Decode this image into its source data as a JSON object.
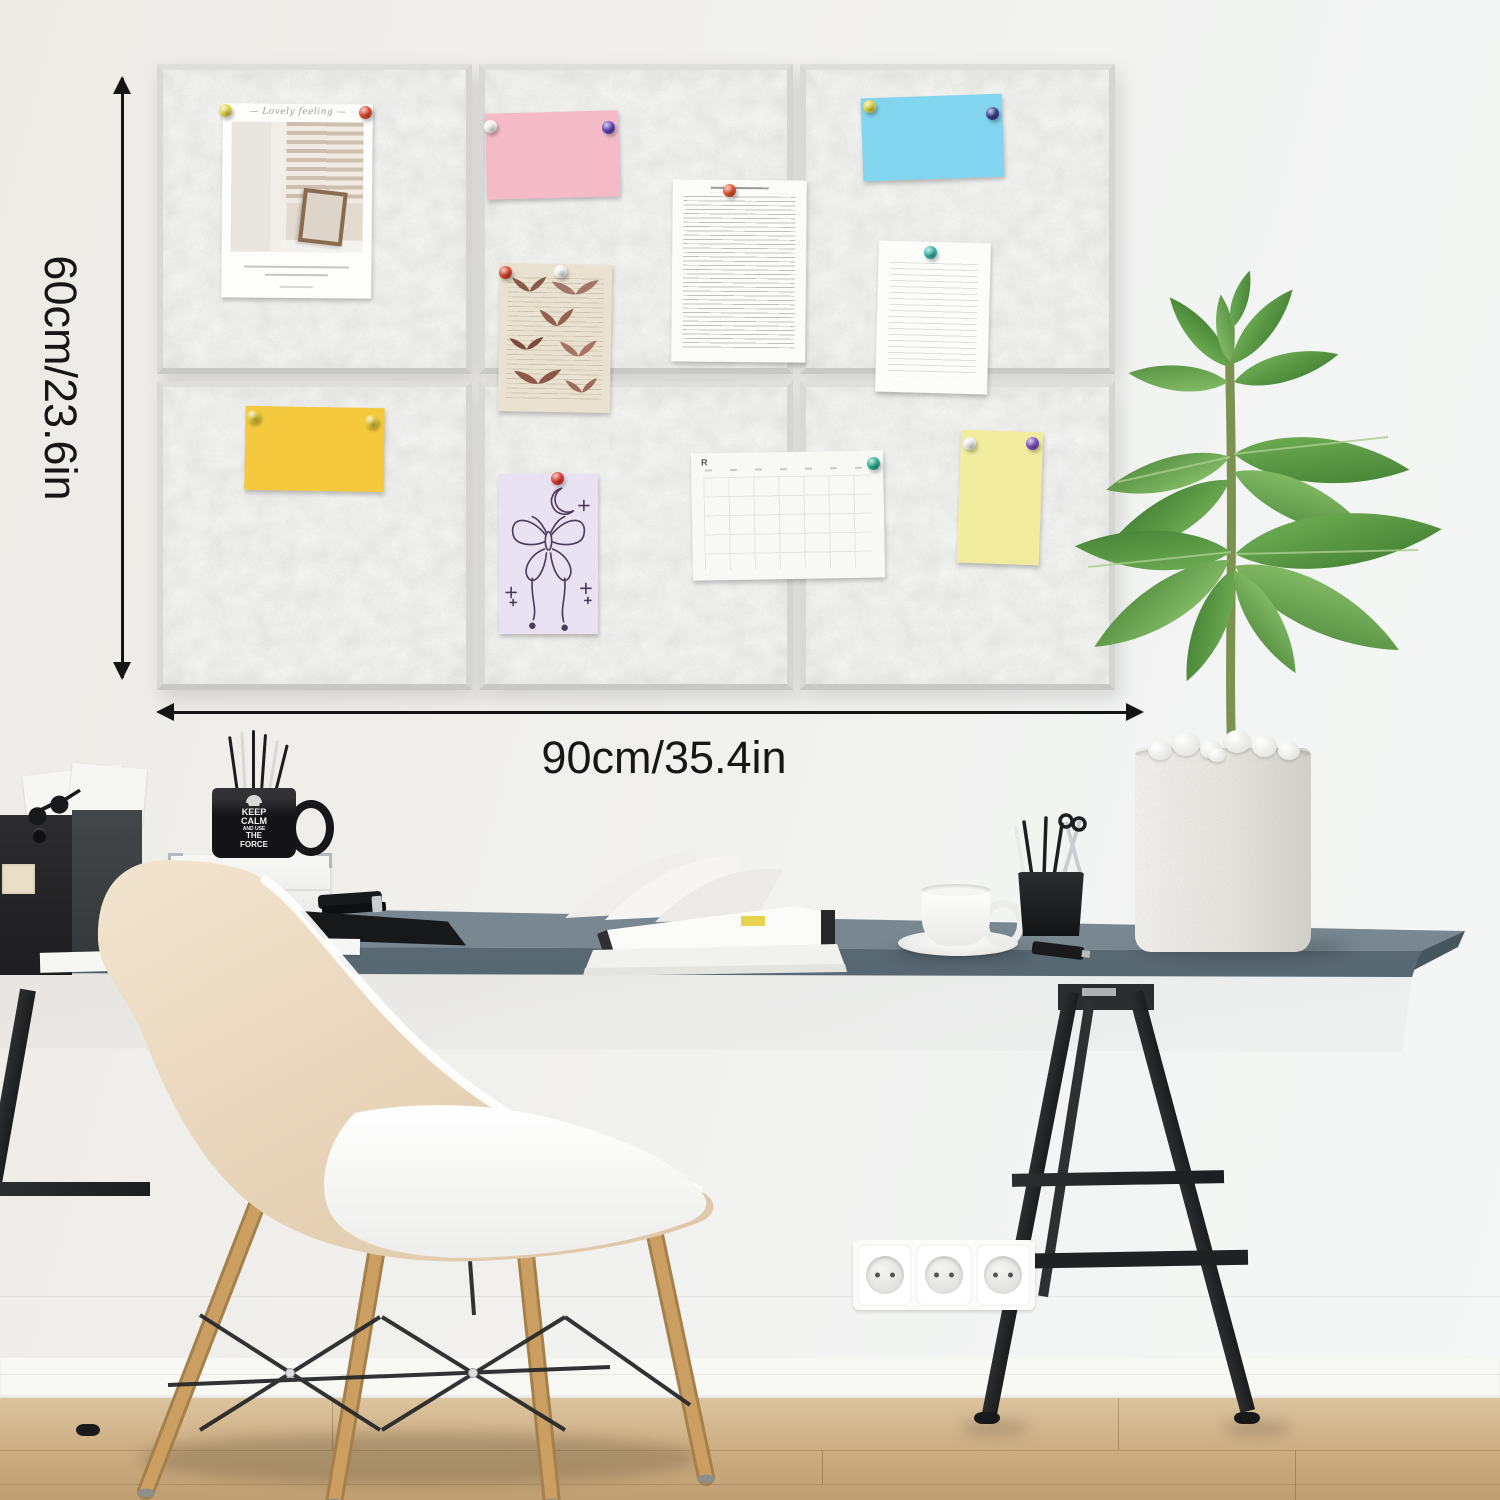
{
  "annotations": {
    "height_label": "60cm/23.6in",
    "width_label": "90cm/35.4in",
    "arrow_color": "#141414"
  },
  "board": {
    "layout": {
      "rows": 2,
      "cols": 3
    },
    "felt_color": "#e9e9e7",
    "edge_color": "#d6d6d4",
    "pinned_items": [
      {
        "name": "polaroid-photo",
        "caption_top": "— Lovely feeling —",
        "pin_colors": [
          "#e5d84b",
          "#e0492c"
        ]
      },
      {
        "name": "pink-lined-note",
        "paper_color": "#f5bac7",
        "pin_colors": [
          "#f3f3f1",
          "#5d47b6"
        ]
      },
      {
        "name": "vintage-butterfly-page",
        "paper_color": "#eae2d0",
        "pin_colors": [
          "#d8432b",
          "#f2f2f0"
        ]
      },
      {
        "name": "typed-text-page",
        "paper_color": "#fbfbf9",
        "pin_colors": [
          "#e4532d"
        ]
      },
      {
        "name": "blue-lined-note",
        "paper_color": "#82d5ef",
        "pin_colors": [
          "#dfd33d",
          "#3a3e8e"
        ]
      },
      {
        "name": "handwritten-page",
        "paper_color": "#fcfcfa",
        "pin_colors": [
          "#35b5a5"
        ]
      },
      {
        "name": "yellow-lined-note",
        "paper_color": "#f4c93e",
        "pin_colors": [
          "#e2cc3b",
          "#e2cc3b"
        ]
      },
      {
        "name": "butterfly-line-drawing",
        "paper_color": "#e9e2f2",
        "pin_colors": [
          "#de382d"
        ]
      },
      {
        "name": "calendar-page",
        "logo": "R",
        "paper_color": "#f8f8f4",
        "pin_colors": [
          "#2aae8f"
        ]
      },
      {
        "name": "pale-yellow-note",
        "paper_color": "#f2ec9f",
        "pin_colors": [
          "#eeeeea",
          "#7a4fbe"
        ]
      }
    ]
  },
  "desk": {
    "top_color": "#75848c",
    "trestle_color": "#232527",
    "mug": {
      "color": "#141416",
      "text_lines": [
        "KEEP",
        "CALM",
        "AND USE",
        "THE",
        "FORCE"
      ]
    },
    "item_names": [
      "document-boxes",
      "papers",
      "sunglasses",
      "storage-case",
      "pen-mug",
      "stapler",
      "desk-folder",
      "open-book",
      "sticky-tab",
      "coffee-cup",
      "pen-holder",
      "scissors",
      "usb-drive",
      "potted-plant"
    ]
  },
  "room": {
    "wall_color": "#f0efec",
    "baseboard_color": "#f8f8f5",
    "floor_color": "#cfb28b",
    "outlets": 3,
    "chair_shell_color": "#ecd9bf",
    "chair_leg_color": "#c9a063",
    "plant_leaf_color": "#4e8a3c",
    "pot_color": "#eceae4"
  }
}
